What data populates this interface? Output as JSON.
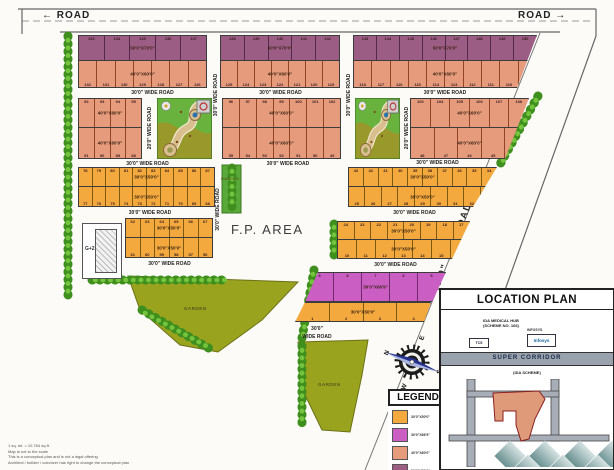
{
  "top": {
    "road_left": "ROAD",
    "road_right": "ROAD",
    "arrow_left": "←",
    "arrow_right": "→"
  },
  "colors": {
    "purple": "#9c5d85",
    "purple_border": "#532a4a",
    "salmon": "#e79b7d",
    "salmon_border": "#8f4526",
    "orange": "#f3a93d",
    "orange_border": "#7d5a0e",
    "magenta": "#ca5ec3",
    "magenta_border": "#6e2a6a"
  },
  "blocks": [
    {
      "id": "block-a",
      "x": 78,
      "y": 35,
      "w": 129,
      "rows": [
        {
          "color": "purple",
          "h": 26,
          "size": "50'0\"X70'0\"",
          "numpos": "top",
          "numbers": [
            "133",
            "134",
            "135",
            "136",
            "137"
          ]
        },
        {
          "color": "salmon",
          "h": 27,
          "size": "40'0\"X60'0\"",
          "numpos": "bottom",
          "numbers": [
            "132",
            "131",
            "130",
            "129",
            "128",
            "127",
            "126"
          ]
        }
      ]
    },
    {
      "id": "block-b",
      "x": 220,
      "y": 35,
      "w": 120,
      "rows": [
        {
          "color": "purple",
          "h": 26,
          "size": "50'0\"X70'0\"",
          "numpos": "top",
          "numbers": [
            "138",
            "139",
            "140",
            "141",
            "142"
          ]
        },
        {
          "color": "salmon",
          "h": 27,
          "size": "40'0\"X60'0\"",
          "numpos": "bottom",
          "numbers": [
            "125",
            "124",
            "123",
            "122",
            "121",
            "120",
            "119"
          ]
        }
      ]
    },
    {
      "id": "block-c",
      "x": 353,
      "y": 35,
      "w": 184,
      "clip": "polygon(0 0, 100% 0, calc(100% - 20px) 100%, 0 100%)",
      "rows": [
        {
          "color": "purple",
          "h": 26,
          "size": "50'0\"X70'0\"",
          "numpos": "top",
          "numbers": [
            "143",
            "144",
            "145",
            "146",
            "147",
            "148",
            "149",
            "150"
          ]
        },
        {
          "color": "salmon",
          "h": 27,
          "size": "40'0\"X60'0\"",
          "numpos": "bottom",
          "numbers": [
            "118",
            "117",
            "116",
            "115",
            "114",
            "113",
            "112",
            "111",
            "110",
            "109"
          ]
        }
      ]
    },
    {
      "id": "block-d",
      "x": 78,
      "y": 98,
      "w": 64,
      "rows": [
        {
          "color": "salmon",
          "h": 30,
          "size": "40'0\"X60'0\"",
          "numpos": "top",
          "numbers": [
            "92",
            "93",
            "94",
            "95"
          ]
        },
        {
          "color": "salmon",
          "h": 31,
          "size": "40'0\"X60'0\"",
          "numpos": "bottom",
          "numbers": [
            "91",
            "90",
            "89",
            "88"
          ]
        }
      ]
    },
    {
      "id": "block-e",
      "x": 222,
      "y": 98,
      "w": 119,
      "rows": [
        {
          "color": "salmon",
          "h": 30,
          "size": "40'0\"X60'0\"",
          "numpos": "top",
          "numbers": [
            "96",
            "97",
            "98",
            "99",
            "100",
            "101",
            "102"
          ]
        },
        {
          "color": "salmon",
          "h": 31,
          "size": "40'0\"X60'0\"",
          "numpos": "bottom",
          "numbers": [
            "55",
            "54",
            "53",
            "52",
            "51",
            "50",
            "49"
          ]
        }
      ]
    },
    {
      "id": "block-f",
      "x": 410,
      "y": 98,
      "w": 119,
      "clip": "polygon(0 0, 100% 0, calc(100% - 24px) 100%, 0 100%)",
      "rows": [
        {
          "color": "salmon",
          "h": 30,
          "size": "40'0\"X60'0\"",
          "numpos": "top",
          "numbers": [
            "103",
            "104",
            "105",
            "106",
            "107",
            "108"
          ]
        },
        {
          "color": "salmon",
          "h": 31,
          "size": "40'0\"X60'0\"",
          "numpos": "bottom",
          "numbers": [
            "48",
            "47",
            "46",
            "45",
            "44"
          ]
        }
      ]
    },
    {
      "id": "block-g",
      "x": 78,
      "y": 167,
      "w": 137,
      "rows": [
        {
          "color": "orange",
          "h": 20,
          "size": "30'0\"X50'0\"",
          "numpos": "top",
          "numbers": [
            "78",
            "79",
            "80",
            "81",
            "82",
            "83",
            "84",
            "85",
            "86",
            "87"
          ]
        },
        {
          "color": "orange",
          "h": 20,
          "size": "30'0\"X50'0\"",
          "numpos": "bottom",
          "numbers": [
            "77",
            "76",
            "75",
            "74",
            "73",
            "72",
            "71",
            "70",
            "69",
            "68"
          ]
        }
      ]
    },
    {
      "id": "block-h",
      "x": 348,
      "y": 167,
      "w": 149,
      "clip": "polygon(0 0, 100% 0, calc(100% - 24px) 100%, 0 100%)",
      "rows": [
        {
          "color": "orange",
          "h": 20,
          "size": "30'0\"X50'0\"",
          "numpos": "top",
          "numbers": [
            "43",
            "42",
            "41",
            "40",
            "39",
            "38",
            "37",
            "36",
            "35",
            "34"
          ]
        },
        {
          "color": "orange",
          "h": 20,
          "size": "30'0\"X50'0\"",
          "numpos": "bottom",
          "numbers": [
            "25",
            "26",
            "27",
            "28",
            "29",
            "30",
            "31",
            "32",
            "33"
          ]
        }
      ]
    },
    {
      "id": "block-i",
      "x": 125,
      "y": 218,
      "w": 88,
      "rows": [
        {
          "color": "orange",
          "h": 20,
          "size": "30'0\"X50'0\"",
          "numpos": "top",
          "numbers": [
            "62",
            "63",
            "64",
            "65",
            "66",
            "67"
          ]
        },
        {
          "color": "orange",
          "h": 20,
          "size": "30'0\"X50'0\"",
          "numpos": "bottom",
          "numbers": [
            "61",
            "60",
            "59",
            "58",
            "57",
            "56"
          ]
        }
      ]
    },
    {
      "id": "block-j",
      "x": 337,
      "y": 221,
      "w": 133,
      "clip": "polygon(0 0, 100% 0, calc(100% - 18px) 100%, 0 100%)",
      "rows": [
        {
          "color": "orange",
          "h": 19,
          "size": "30'0\"X50'0\"",
          "numpos": "top",
          "numbers": [
            "24",
            "23",
            "22",
            "21",
            "20",
            "19",
            "18",
            "17"
          ]
        },
        {
          "color": "orange",
          "h": 19,
          "size": "30'0\"X50'0\"",
          "numpos": "bottom",
          "numbers": [
            "10",
            "11",
            "12",
            "13",
            "14",
            "15",
            "16"
          ]
        }
      ]
    },
    {
      "id": "block-k",
      "x": 305,
      "y": 272,
      "w": 141,
      "clip": "polygon(13px 0, 100% 0, calc(100% - 14px) 100%, 0 100%)",
      "rows": [
        {
          "color": "magenta",
          "h": 30,
          "size": "30'0\"X66'9\"",
          "numpos": "top",
          "numbers": [
            "9",
            "8",
            "7",
            "6",
            "5"
          ]
        }
      ]
    },
    {
      "id": "block-strip",
      "x": 295,
      "y": 302,
      "w": 136,
      "clip": "polygon(10px 0, 100% 0, calc(100% - 7px) 100%, 0 100%)",
      "rows": [
        {
          "color": "orange",
          "h": 20,
          "size": "30'0\"X50'0\"",
          "numpos": "bottom",
          "numbers": [
            "1",
            "2",
            "3",
            "4"
          ]
        }
      ]
    }
  ],
  "road_labels": [
    {
      "text": "30'0\" WIDE ROAD",
      "x": 100,
      "y": 90,
      "w": 105
    },
    {
      "text": "30'0\" WIDE ROAD",
      "x": 228,
      "y": 90,
      "w": 105
    },
    {
      "text": "30'0\" WIDE ROAD",
      "x": 380,
      "y": 90,
      "w": 130
    },
    {
      "text": "30'0\" WIDE ROAD",
      "x": 95,
      "y": 161,
      "w": 105
    },
    {
      "text": "30'0\" WIDE ROAD",
      "x": 238,
      "y": 161,
      "w": 100
    },
    {
      "text": "30'0\" WIDE ROAD",
      "x": 385,
      "y": 160,
      "w": 105
    },
    {
      "text": "30'0\" WIDE ROAD",
      "x": 100,
      "y": 210,
      "w": 100
    },
    {
      "text": "30'0\" WIDE ROAD",
      "x": 362,
      "y": 210,
      "w": 105
    },
    {
      "text": "30'0\" WIDE ROAD",
      "x": 122,
      "y": 261,
      "w": 95
    },
    {
      "text": "30'0\" WIDE ROAD",
      "x": 348,
      "y": 262,
      "w": 95
    },
    {
      "text": "30'0\"",
      "x": 302,
      "y": 326,
      "w": 30
    },
    {
      "text": "WIDE ROAD",
      "x": 292,
      "y": 334,
      "w": 50
    },
    {
      "text": "30'0\" WIDE ROAD",
      "x": 213,
      "y": 150,
      "w": 110,
      "rot": -90
    },
    {
      "text": "30'0\" WIDE ROAD",
      "x": 346,
      "y": 150,
      "w": 110,
      "rot": -90
    },
    {
      "text": "20'0\" WIDE ROAD",
      "x": 147,
      "y": 157,
      "w": 58,
      "rot": -90
    },
    {
      "text": "20'0\" WIDE ROAD",
      "x": 404,
      "y": 157,
      "w": 58,
      "rot": -90
    },
    {
      "text": "30'0\" WIDE ROAD",
      "x": 215,
      "y": 252,
      "w": 85,
      "rot": -90
    }
  ],
  "diagonal_road_label": "40'0\" WD. ROAD",
  "fp_area": "F.P. AREA",
  "g2_label": "G+2",
  "gardens": [
    {
      "label": "GARDEN",
      "x": 184,
      "y": 306,
      "size": 4.5
    },
    {
      "label": "GARDEN",
      "x": 318,
      "y": 382,
      "size": 4.5
    },
    {
      "label": "GARDEN",
      "x": 221,
      "y": 177,
      "size": 3.5
    }
  ],
  "compass": {
    "n": "N",
    "e": "E",
    "s": "S",
    "w": "W"
  },
  "legend": {
    "title": "LEGEND",
    "items": [
      {
        "color": "#f3a93d",
        "label": "30'0\"X50'0\""
      },
      {
        "color": "#ca5ec3",
        "label": "30'0\"X66'9\""
      },
      {
        "color": "#e79b7d",
        "label": "40'0\"X60'0\""
      },
      {
        "color": "#9c5d85",
        "label": "50'0\"X70'0\""
      }
    ]
  },
  "location_plan": {
    "title": "LOCATION PLAN",
    "hub_line1": "IDA MEDICAL HUB",
    "hub_line2": "(SCHEME NO. 166)",
    "tcs": "TCS",
    "infosys_caption": "INFOSYS",
    "infosys": "Infosys",
    "corridor": "SUPER CORRIDOR",
    "scheme": "(IDA SCHEME)"
  },
  "disclaimer": [
    "1 sq. mt. = 10.764 sq.ft.",
    "Map is not to the scale",
    "This is a conceptual plan and is not a legal offering",
    "Architect / builder / colonizer has right to change the conceptual plan"
  ]
}
